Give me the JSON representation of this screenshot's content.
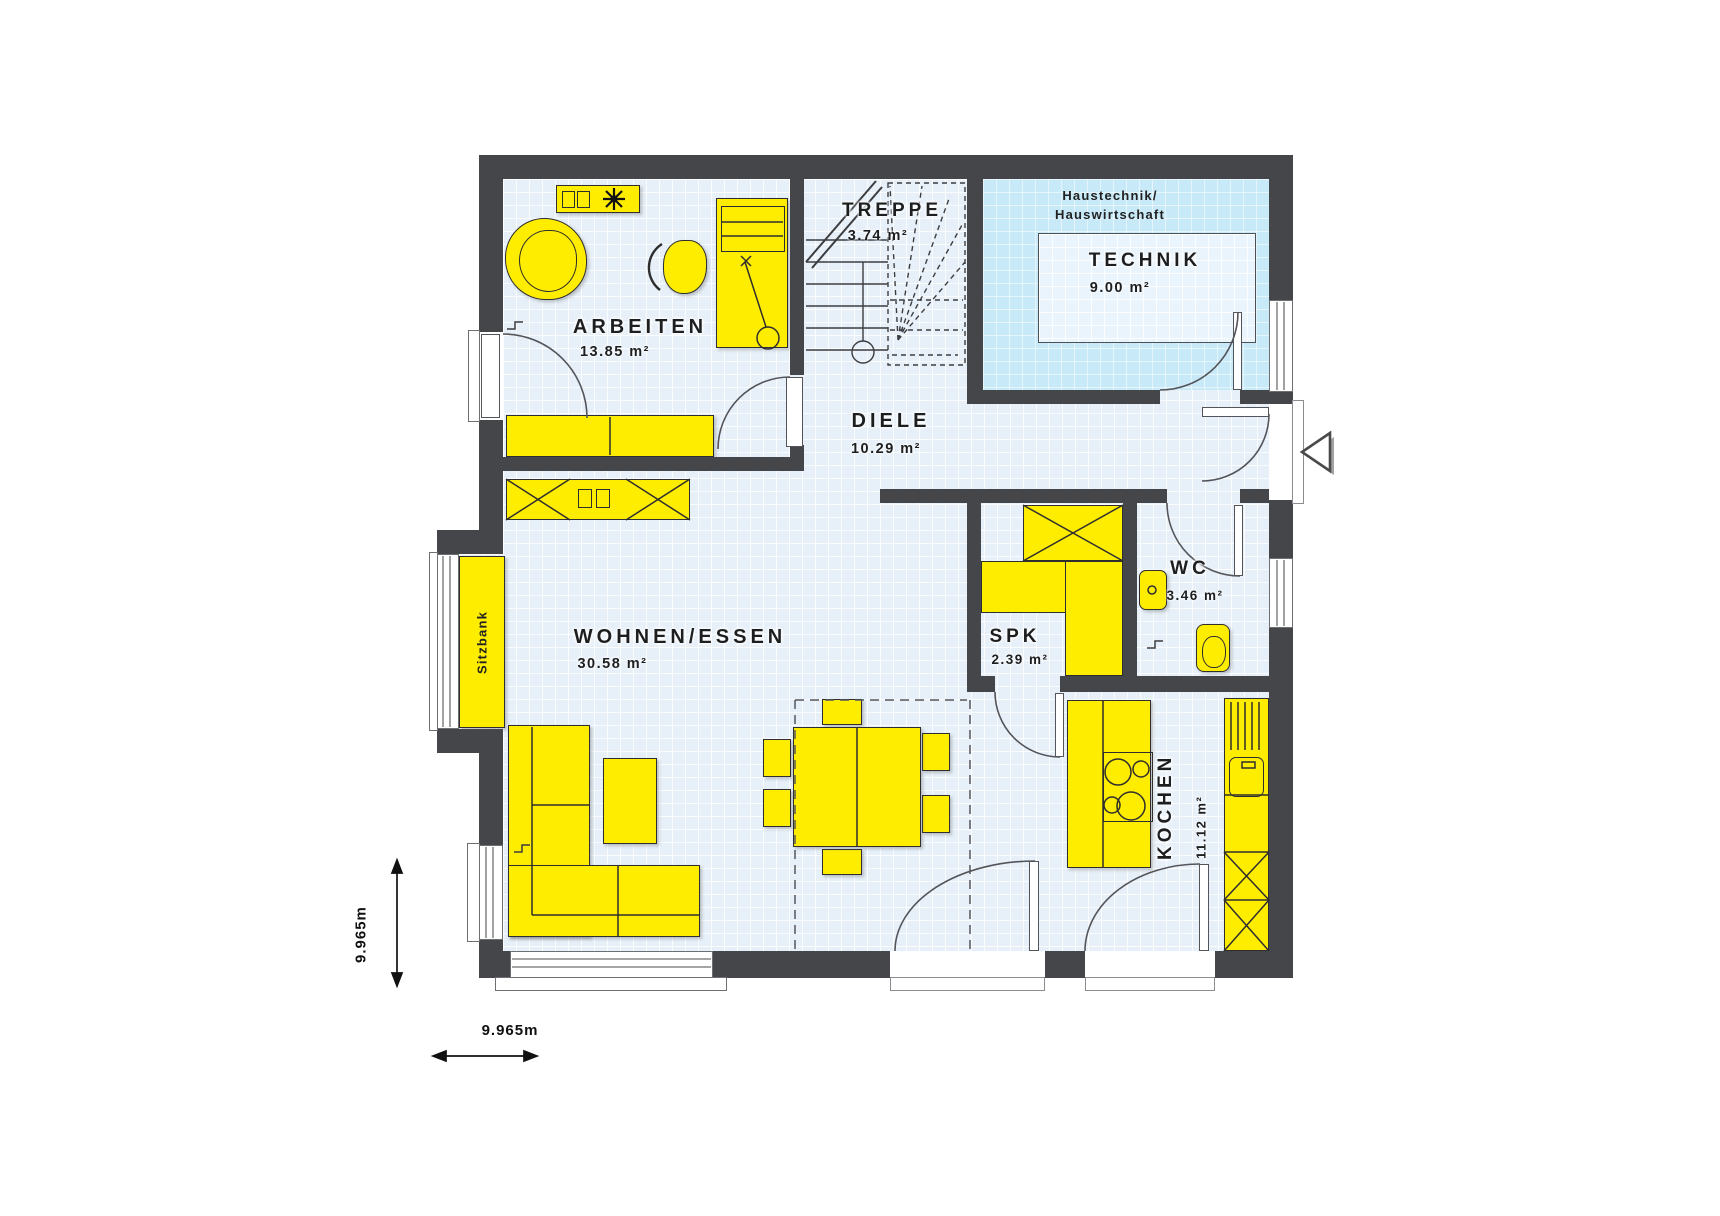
{
  "plan": {
    "rooms": {
      "arbeiten": {
        "name": "ARBEITEN",
        "area": "13.85 m²"
      },
      "treppe": {
        "name": "TREPPE",
        "area": "3.74 m²"
      },
      "technik": {
        "name": "TECHNIK",
        "area": "9.00 m²",
        "zone_line1": "Haustechnik/",
        "zone_line2": "Hauswirtschaft"
      },
      "diele": {
        "name": "DIELE",
        "area": "10.29 m²"
      },
      "wohnen_essen": {
        "name": "WOHNEN/ESSEN",
        "area": "30.58 m²"
      },
      "spk": {
        "name": "SPK",
        "area": "2.39 m²"
      },
      "wc": {
        "name": "WC",
        "area": "3.46 m²"
      },
      "kochen": {
        "name": "KOCHEN",
        "area": "11.12 m²"
      }
    },
    "furniture": {
      "bench_label": "Sitzbank"
    },
    "dimensions": {
      "width_label": "9.965m",
      "height_label": "9.965m"
    },
    "icons": {
      "entrance_arrow": "◁",
      "plant": "✳"
    },
    "colors": {
      "wall": "#45464a",
      "floor": "#e7f0f9",
      "furniture_yellow": "#ffed00",
      "technik_room_blue": "#c7e9f8",
      "technik_inset": "#e9f4fc",
      "outline": "#2e2e2e"
    }
  }
}
